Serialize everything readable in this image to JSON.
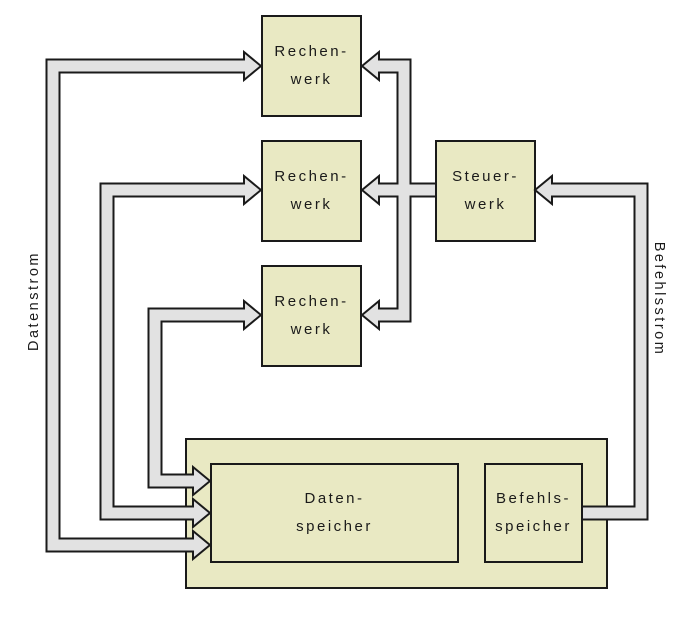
{
  "nodes": {
    "rechenwerk_1": {
      "label_line1": "Rechen-",
      "label_line2": "werk"
    },
    "rechenwerk_2": {
      "label_line1": "Rechen-",
      "label_line2": "werk"
    },
    "rechenwerk_3": {
      "label_line1": "Rechen-",
      "label_line2": "werk"
    },
    "steuerwerk": {
      "label_line1": "Steuer-",
      "label_line2": "werk"
    },
    "datenspeicher": {
      "label_line1": "Daten-",
      "label_line2": "speicher"
    },
    "befehlsspeicher": {
      "label_line1": "Befehls-",
      "label_line2": "speicher"
    }
  },
  "streams": {
    "data_stream_label": "Datenstrom",
    "instruction_stream_label": "Befehlsstrom"
  },
  "colors": {
    "node_fill": "#e9e9c3",
    "node_border": "#1a1a1a",
    "pipe_fill": "#e2e2e2",
    "pipe_border": "#1a1a1a",
    "background": "#ffffff",
    "text": "#1a1a1a"
  }
}
